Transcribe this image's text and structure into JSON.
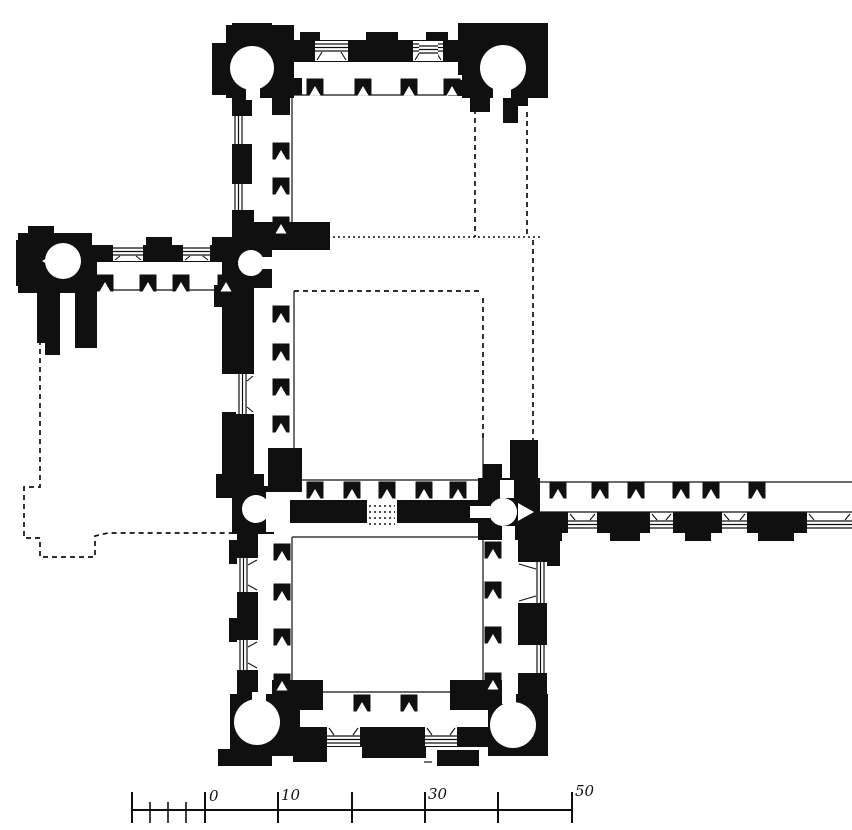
{
  "figure": {
    "kind": "architectural-floor-plan",
    "ink": "#101010",
    "paper": "#ffffff",
    "canvas": {
      "width": 852,
      "height": 830
    }
  },
  "scale_bar": {
    "labels": [
      {
        "text": "0",
        "x": 209,
        "y": 801
      },
      {
        "text": "10",
        "x": 281,
        "y": 800
      },
      {
        "text": "30",
        "x": 428,
        "y": 799
      },
      {
        "text": "50",
        "x": 575,
        "y": 796
      }
    ],
    "line": {
      "x1": 132,
      "y1": 810,
      "x2": 573,
      "y2": 810
    },
    "major_ticks": [
      132,
      205,
      278,
      352,
      425,
      498,
      572
    ],
    "major_tick_y": [
      792,
      823
    ],
    "minor_ticks": [
      150,
      168,
      186
    ],
    "minor_tick_y": [
      802,
      823
    ]
  },
  "plan": {
    "walls": [
      [
        212,
        43,
        24,
        52
      ],
      [
        226,
        25,
        68,
        73
      ],
      [
        232,
        23,
        40,
        8
      ],
      [
        228,
        40,
        320,
        22
      ],
      [
        300,
        32,
        20,
        10
      ],
      [
        366,
        32,
        32,
        10
      ],
      [
        426,
        32,
        22,
        10
      ],
      [
        458,
        23,
        90,
        52
      ],
      [
        462,
        40,
        86,
        58
      ],
      [
        232,
        60,
        20,
        186
      ],
      [
        268,
        78,
        34,
        17
      ],
      [
        272,
        95,
        18,
        20
      ],
      [
        448,
        80,
        42,
        16
      ],
      [
        470,
        80,
        20,
        32
      ],
      [
        503,
        80,
        25,
        26
      ],
      [
        503,
        80,
        15,
        43
      ],
      [
        252,
        222,
        78,
        28
      ],
      [
        232,
        210,
        22,
        52
      ],
      [
        230,
        238,
        42,
        50
      ],
      [
        18,
        233,
        74,
        60
      ],
      [
        28,
        226,
        26,
        10
      ],
      [
        16,
        240,
        12,
        46
      ],
      [
        37,
        287,
        23,
        56
      ],
      [
        45,
        320,
        15,
        35
      ],
      [
        75,
        262,
        22,
        86
      ],
      [
        42,
        245,
        200,
        17
      ],
      [
        56,
        237,
        24,
        9
      ],
      [
        146,
        237,
        26,
        9
      ],
      [
        212,
        237,
        24,
        9
      ],
      [
        222,
        262,
        32,
        112
      ],
      [
        244,
        374,
        10,
        14
      ],
      [
        222,
        412,
        32,
        64
      ],
      [
        214,
        285,
        12,
        22
      ],
      [
        216,
        474,
        48,
        24
      ],
      [
        232,
        486,
        42,
        48
      ],
      [
        268,
        448,
        34,
        44
      ],
      [
        483,
        464,
        19,
        16
      ],
      [
        510,
        440,
        28,
        40
      ],
      [
        256,
        500,
        111,
        23
      ],
      [
        397,
        500,
        81,
        23
      ],
      [
        478,
        478,
        62,
        62
      ],
      [
        540,
        512,
        28,
        21
      ],
      [
        597,
        512,
        53,
        21
      ],
      [
        673,
        512,
        49,
        21
      ],
      [
        747,
        512,
        60,
        21
      ],
      [
        548,
        533,
        14,
        8
      ],
      [
        610,
        533,
        30,
        8
      ],
      [
        685,
        533,
        26,
        8
      ],
      [
        758,
        533,
        36,
        8
      ],
      [
        237,
        523,
        21,
        174
      ],
      [
        229,
        540,
        8,
        24
      ],
      [
        229,
        618,
        8,
        24
      ],
      [
        518,
        533,
        29,
        166
      ],
      [
        547,
        528,
        13,
        38
      ],
      [
        272,
        680,
        51,
        30
      ],
      [
        450,
        680,
        52,
        30
      ],
      [
        230,
        694,
        70,
        62
      ],
      [
        218,
        749,
        54,
        17
      ],
      [
        280,
        727,
        216,
        20
      ],
      [
        293,
        747,
        34,
        15
      ],
      [
        362,
        745,
        64,
        13
      ],
      [
        437,
        750,
        42,
        16
      ],
      [
        488,
        694,
        60,
        62
      ]
    ],
    "towers": [
      [
        252,
        68,
        22
      ],
      [
        503,
        68,
        23
      ],
      [
        63,
        261,
        18
      ],
      [
        251,
        263,
        13
      ],
      [
        256,
        509,
        14
      ],
      [
        503,
        512,
        14
      ],
      [
        257,
        722,
        23
      ],
      [
        513,
        725,
        23
      ]
    ],
    "white_rects": [
      [
        246,
        86,
        14,
        14
      ],
      [
        493,
        85,
        18,
        13
      ],
      [
        260,
        257,
        30,
        12
      ],
      [
        266,
        492,
        24,
        40
      ],
      [
        500,
        480,
        14,
        18
      ],
      [
        502,
        526,
        13,
        22
      ],
      [
        470,
        506,
        20,
        12
      ],
      [
        502,
        690,
        14,
        14
      ],
      [
        252,
        692,
        14,
        12
      ]
    ],
    "white_triangles": [
      [
        [
          42,
          261
        ],
        [
          57,
          252
        ],
        [
          57,
          270
        ]
      ],
      [
        [
          518,
          503
        ],
        [
          534,
          512
        ],
        [
          518,
          521
        ]
      ]
    ],
    "piers": [
      [
        315,
        87
      ],
      [
        363,
        87
      ],
      [
        409,
        87
      ],
      [
        452,
        87
      ],
      [
        281,
        151
      ],
      [
        281,
        186
      ],
      [
        281,
        225
      ],
      [
        105,
        283
      ],
      [
        148,
        283
      ],
      [
        181,
        283
      ],
      [
        226,
        283
      ],
      [
        281,
        314
      ],
      [
        281,
        352
      ],
      [
        281,
        387
      ],
      [
        281,
        424
      ],
      [
        315,
        490
      ],
      [
        352,
        490
      ],
      [
        387,
        490
      ],
      [
        424,
        490
      ],
      [
        458,
        490
      ],
      [
        558,
        490
      ],
      [
        600,
        490
      ],
      [
        636,
        490
      ],
      [
        681,
        490
      ],
      [
        711,
        490
      ],
      [
        757,
        490
      ],
      [
        282,
        552
      ],
      [
        282,
        592
      ],
      [
        282,
        637
      ],
      [
        282,
        682
      ],
      [
        493,
        550
      ],
      [
        493,
        590
      ],
      [
        493,
        635
      ],
      [
        493,
        681
      ],
      [
        362,
        703
      ],
      [
        409,
        703
      ]
    ],
    "windows": [
      {
        "x": 315,
        "y": 41,
        "w": 33,
        "h": 20,
        "o": "h",
        "edge": "top"
      },
      {
        "x": 413,
        "y": 41,
        "w": 30,
        "h": 20,
        "o": "h",
        "edge": "top"
      },
      {
        "x": 419,
        "y": 43,
        "w": 19,
        "h": 13,
        "o": "h",
        "edge": "top"
      },
      {
        "x": 113,
        "y": 245,
        "w": 30,
        "h": 16,
        "o": "h",
        "edge": "top"
      },
      {
        "x": 183,
        "y": 245,
        "w": 27,
        "h": 16,
        "o": "h",
        "edge": "top"
      },
      {
        "x": 568,
        "y": 513,
        "w": 29,
        "h": 18,
        "o": "h",
        "edge": "bot"
      },
      {
        "x": 650,
        "y": 513,
        "w": 23,
        "h": 18,
        "o": "h",
        "edge": "bot"
      },
      {
        "x": 722,
        "y": 513,
        "w": 25,
        "h": 18,
        "o": "h",
        "edge": "bot"
      },
      {
        "x": 807,
        "y": 513,
        "w": 45,
        "h": 18,
        "o": "h",
        "edge": "bot"
      },
      {
        "x": 327,
        "y": 727,
        "w": 33,
        "h": 19,
        "o": "h",
        "edge": "bot"
      },
      {
        "x": 425,
        "y": 727,
        "w": 32,
        "h": 19,
        "o": "h",
        "edge": "bot"
      },
      {
        "x": 232,
        "y": 116,
        "w": 20,
        "h": 28,
        "o": "v",
        "edge": "left"
      },
      {
        "x": 232,
        "y": 184,
        "w": 20,
        "h": 26,
        "o": "v",
        "edge": "left"
      },
      {
        "x": 236,
        "y": 374,
        "w": 18,
        "h": 40,
        "o": "v",
        "edge": "left"
      },
      {
        "x": 237,
        "y": 558,
        "w": 21,
        "h": 34,
        "o": "v",
        "edge": "left"
      },
      {
        "x": 237,
        "y": 640,
        "w": 21,
        "h": 30,
        "o": "v",
        "edge": "left"
      },
      {
        "x": 518,
        "y": 562,
        "w": 29,
        "h": 41,
        "o": "v",
        "edge": "right"
      },
      {
        "x": 518,
        "y": 645,
        "w": 29,
        "h": 28,
        "o": "v",
        "edge": "right"
      }
    ],
    "dashed": [
      {
        "style": "dash",
        "pts": [
          [
            475,
            100
          ],
          [
            475,
            237
          ]
        ]
      },
      {
        "style": "dash",
        "pts": [
          [
            527,
            112
          ],
          [
            527,
            237
          ]
        ]
      },
      {
        "style": "dot",
        "pts": [
          [
            333,
            237
          ],
          [
            540,
            237
          ]
        ]
      },
      {
        "style": "dash",
        "pts": [
          [
            294,
            291
          ],
          [
            480,
            291
          ]
        ]
      },
      {
        "style": "dash",
        "pts": [
          [
            483,
            298
          ],
          [
            483,
            438
          ]
        ]
      },
      {
        "style": "dash",
        "pts": [
          [
            533,
            240
          ],
          [
            533,
            442
          ]
        ]
      },
      {
        "style": "dash",
        "pts": [
          [
            40,
            340
          ],
          [
            40,
            487
          ],
          [
            24,
            487
          ],
          [
            24,
            538
          ],
          [
            40,
            538
          ],
          [
            40,
            557
          ],
          [
            95,
            557
          ],
          [
            95,
            536
          ],
          [
            108,
            533
          ],
          [
            236,
            533
          ]
        ]
      },
      {
        "style": "dot",
        "pts": [
          [
            369,
            506
          ],
          [
            395,
            506
          ]
        ]
      },
      {
        "style": "dot",
        "pts": [
          [
            369,
            512
          ],
          [
            395,
            512
          ]
        ]
      },
      {
        "style": "dot",
        "pts": [
          [
            369,
            518
          ],
          [
            395,
            518
          ]
        ]
      },
      {
        "style": "dot",
        "pts": [
          [
            369,
            524
          ],
          [
            395,
            524
          ]
        ]
      },
      {
        "style": "dot",
        "pts": [
          [
            316,
            59
          ],
          [
            347,
            59
          ]
        ]
      },
      {
        "style": "dot",
        "pts": [
          [
            414,
            59
          ],
          [
            442,
            59
          ]
        ]
      },
      {
        "style": "dot",
        "pts": [
          [
            114,
            260
          ],
          [
            142,
            260
          ]
        ]
      },
      {
        "style": "dot",
        "pts": [
          [
            184,
            260
          ],
          [
            209,
            260
          ]
        ]
      },
      {
        "style": "dot",
        "pts": [
          [
            252,
            388
          ],
          [
            252,
            412
          ]
        ]
      }
    ],
    "thin_lines": [
      [
        [
          292,
          95
        ],
        [
          473,
          95
        ]
      ],
      [
        [
          292,
          95
        ],
        [
          292,
          222
        ]
      ],
      [
        [
          294,
          291
        ],
        [
          294,
          480
        ]
      ],
      [
        [
          294,
          480
        ],
        [
          483,
          480
        ]
      ],
      [
        [
          483,
          438
        ],
        [
          483,
          480
        ]
      ],
      [
        [
          292,
          537
        ],
        [
          483,
          537
        ]
      ],
      [
        [
          292,
          537
        ],
        [
          292,
          692
        ]
      ],
      [
        [
          483,
          537
        ],
        [
          483,
          692
        ]
      ],
      [
        [
          292,
          692
        ],
        [
          483,
          692
        ]
      ],
      [
        [
          540,
          482
        ],
        [
          852,
          482
        ]
      ],
      [
        [
          540,
          512
        ],
        [
          852,
          512
        ]
      ],
      [
        [
          97,
          290
        ],
        [
          240,
          290
        ]
      ],
      [
        [
          239,
          375
        ],
        [
          239,
          412
        ]
      ],
      [
        [
          424,
          762
        ],
        [
          432,
          762
        ]
      ]
    ]
  }
}
